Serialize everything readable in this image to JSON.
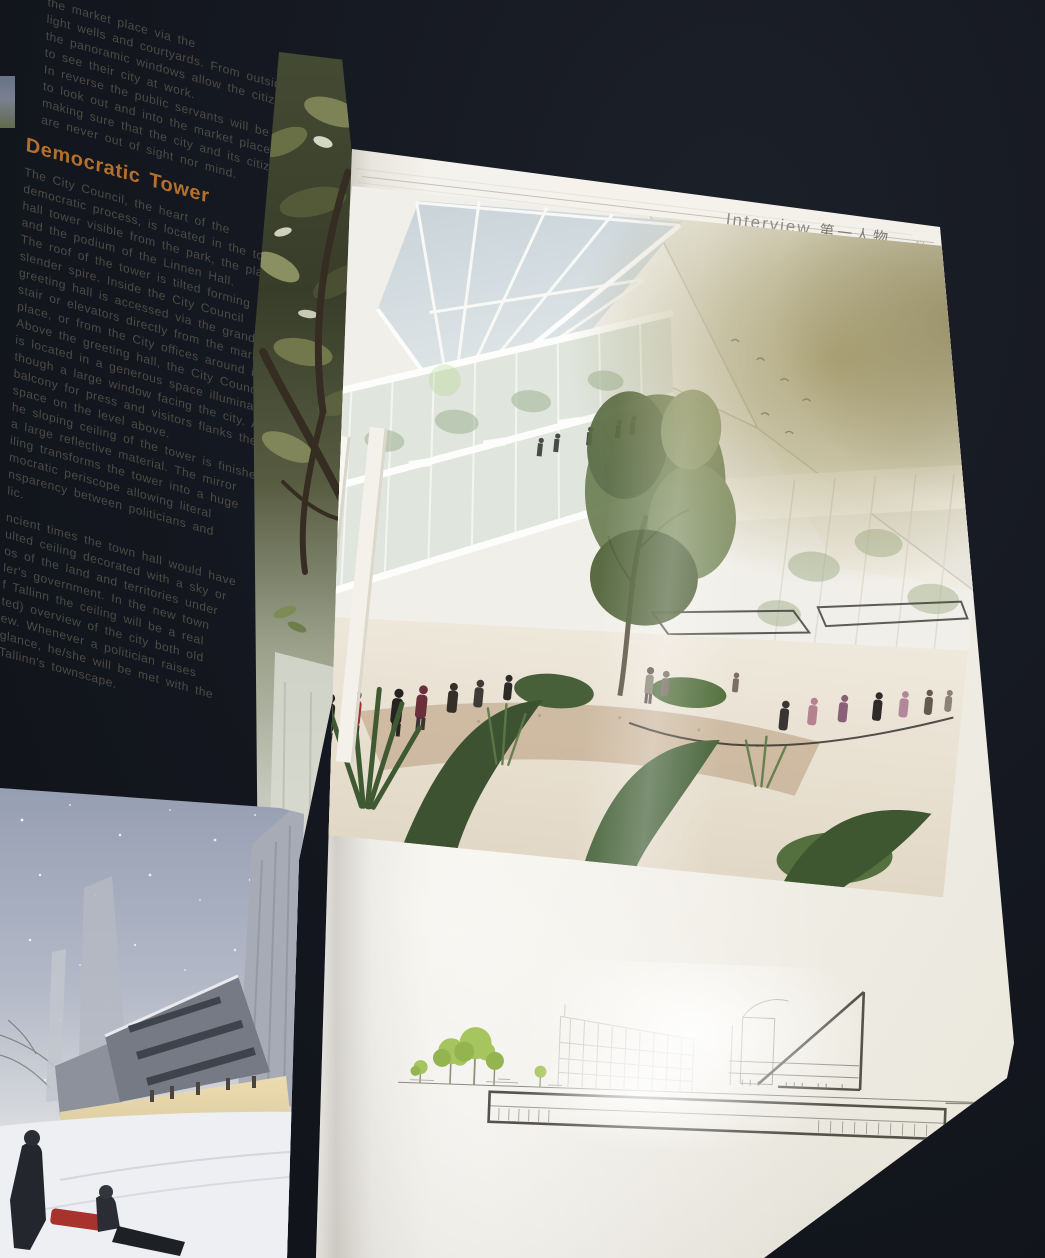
{
  "header": {
    "section_en": "Interview",
    "section_cn": "第一人物",
    "page_number": "43"
  },
  "left_column": {
    "intro": "the market place via the\nlight wells and courtyards. From outside\nthe panoramic windows allow the citizens\nto see their city at work.\nIn reverse the public servants will be able\nto look out and into the market place's\nmaking sure that the city and its citizens\nare never out of sight nor mind.",
    "heading": "Democratic Tower",
    "body_1": "The City Council, the heart of the\ndemocratic process, is located in the town\nhall tower visible from the park, the plaza\nand the podium of the Linnen Hall.\nThe roof of the tower is tilted forming a\nslender spire. Inside the City Council\ngreeting hall is accessed via the grand\nstair or elevators directly from the market\nplace, or from the City offices around it.\nAbove the greeting hall, the City Council\nis located in a generous space illuminated\nthough a large window facing the city. A\nbalcony for press and visitors flanks the\nspace on the level above.\nhe sloping ceiling of the tower is finished\na large reflective material. The mirror\niling transforms the tower into a huge\nmocratic periscope allowing literal\nnsparency between politicians and\nlic.",
    "body_2": "ncient times the town hall would have\nulted ceiling decorated with a sky or\nos of the land and territories under\nler's government. In the new town\nf Tallinn the ceiling will be a real\nted) overview of the city both old\new. Whenever a politician raises\nglance, he/she will be met with the\nTallinn's townscape."
  },
  "colors": {
    "background": "#14171f",
    "paper": "#f3f1ea",
    "heading_orange": "#b2702c",
    "body_text": "#4d4b46",
    "header_gray": "#8e8d88",
    "rule": "#c3c0b6",
    "drawing_line": "#55524a",
    "drawing_tree_green": "#a6c55e",
    "glare_gold": "#978b55"
  }
}
